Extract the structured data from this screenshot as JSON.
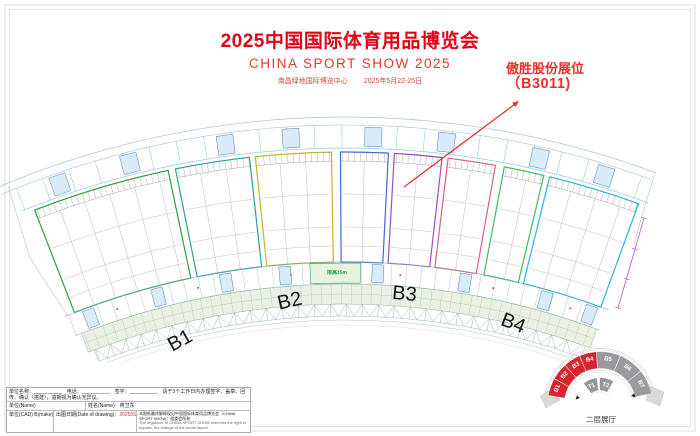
{
  "header": {
    "title": "2025中国国际体育用品博览会",
    "subtitle": "CHINA SPORT SHOW 2025",
    "venue": "南昌绿地国际博览中心",
    "dates": "2025年5月22-25日",
    "accent_color": "#e60014"
  },
  "annotation": {
    "line1": "傲胜股份展位",
    "line2": "（B3011)"
  },
  "halls": [
    "B1",
    "B2",
    "B3",
    "B4"
  ],
  "plan": {
    "walkway_label": "限高15m"
  },
  "minimap": {
    "red": [
      "B1",
      "B2",
      "B3",
      "B4"
    ],
    "gray": [
      "B5",
      "B6",
      "B7"
    ],
    "inner": [
      "T1",
      "T2"
    ],
    "caption": "二层展厅",
    "red_color": "#d8242e",
    "gray_color": "#9b9b9f"
  },
  "titleblock": {
    "row1": "单位名称：__________　电话：__________　签字：__________　请于3个工作日内办理签字、盖章、回传、确认（搭建），逾期视为确认无异议。",
    "unit_label": "单位(Name)",
    "name_label": "姓名(Name)：蒋卫东",
    "cad_label": "单位(CAD) B(make)",
    "date_label": "出图日期(Date of drawing)：",
    "date_value": "2025/02/22 15:12",
    "note_cn": "本图纸最终解释权归中国国际体育用品博览会（CHINA SPORT SHOW）组委会所有",
    "note_en": "The organizer of CHINA SPORT SHOW reserves the right to explain, the change of the booth layout."
  }
}
